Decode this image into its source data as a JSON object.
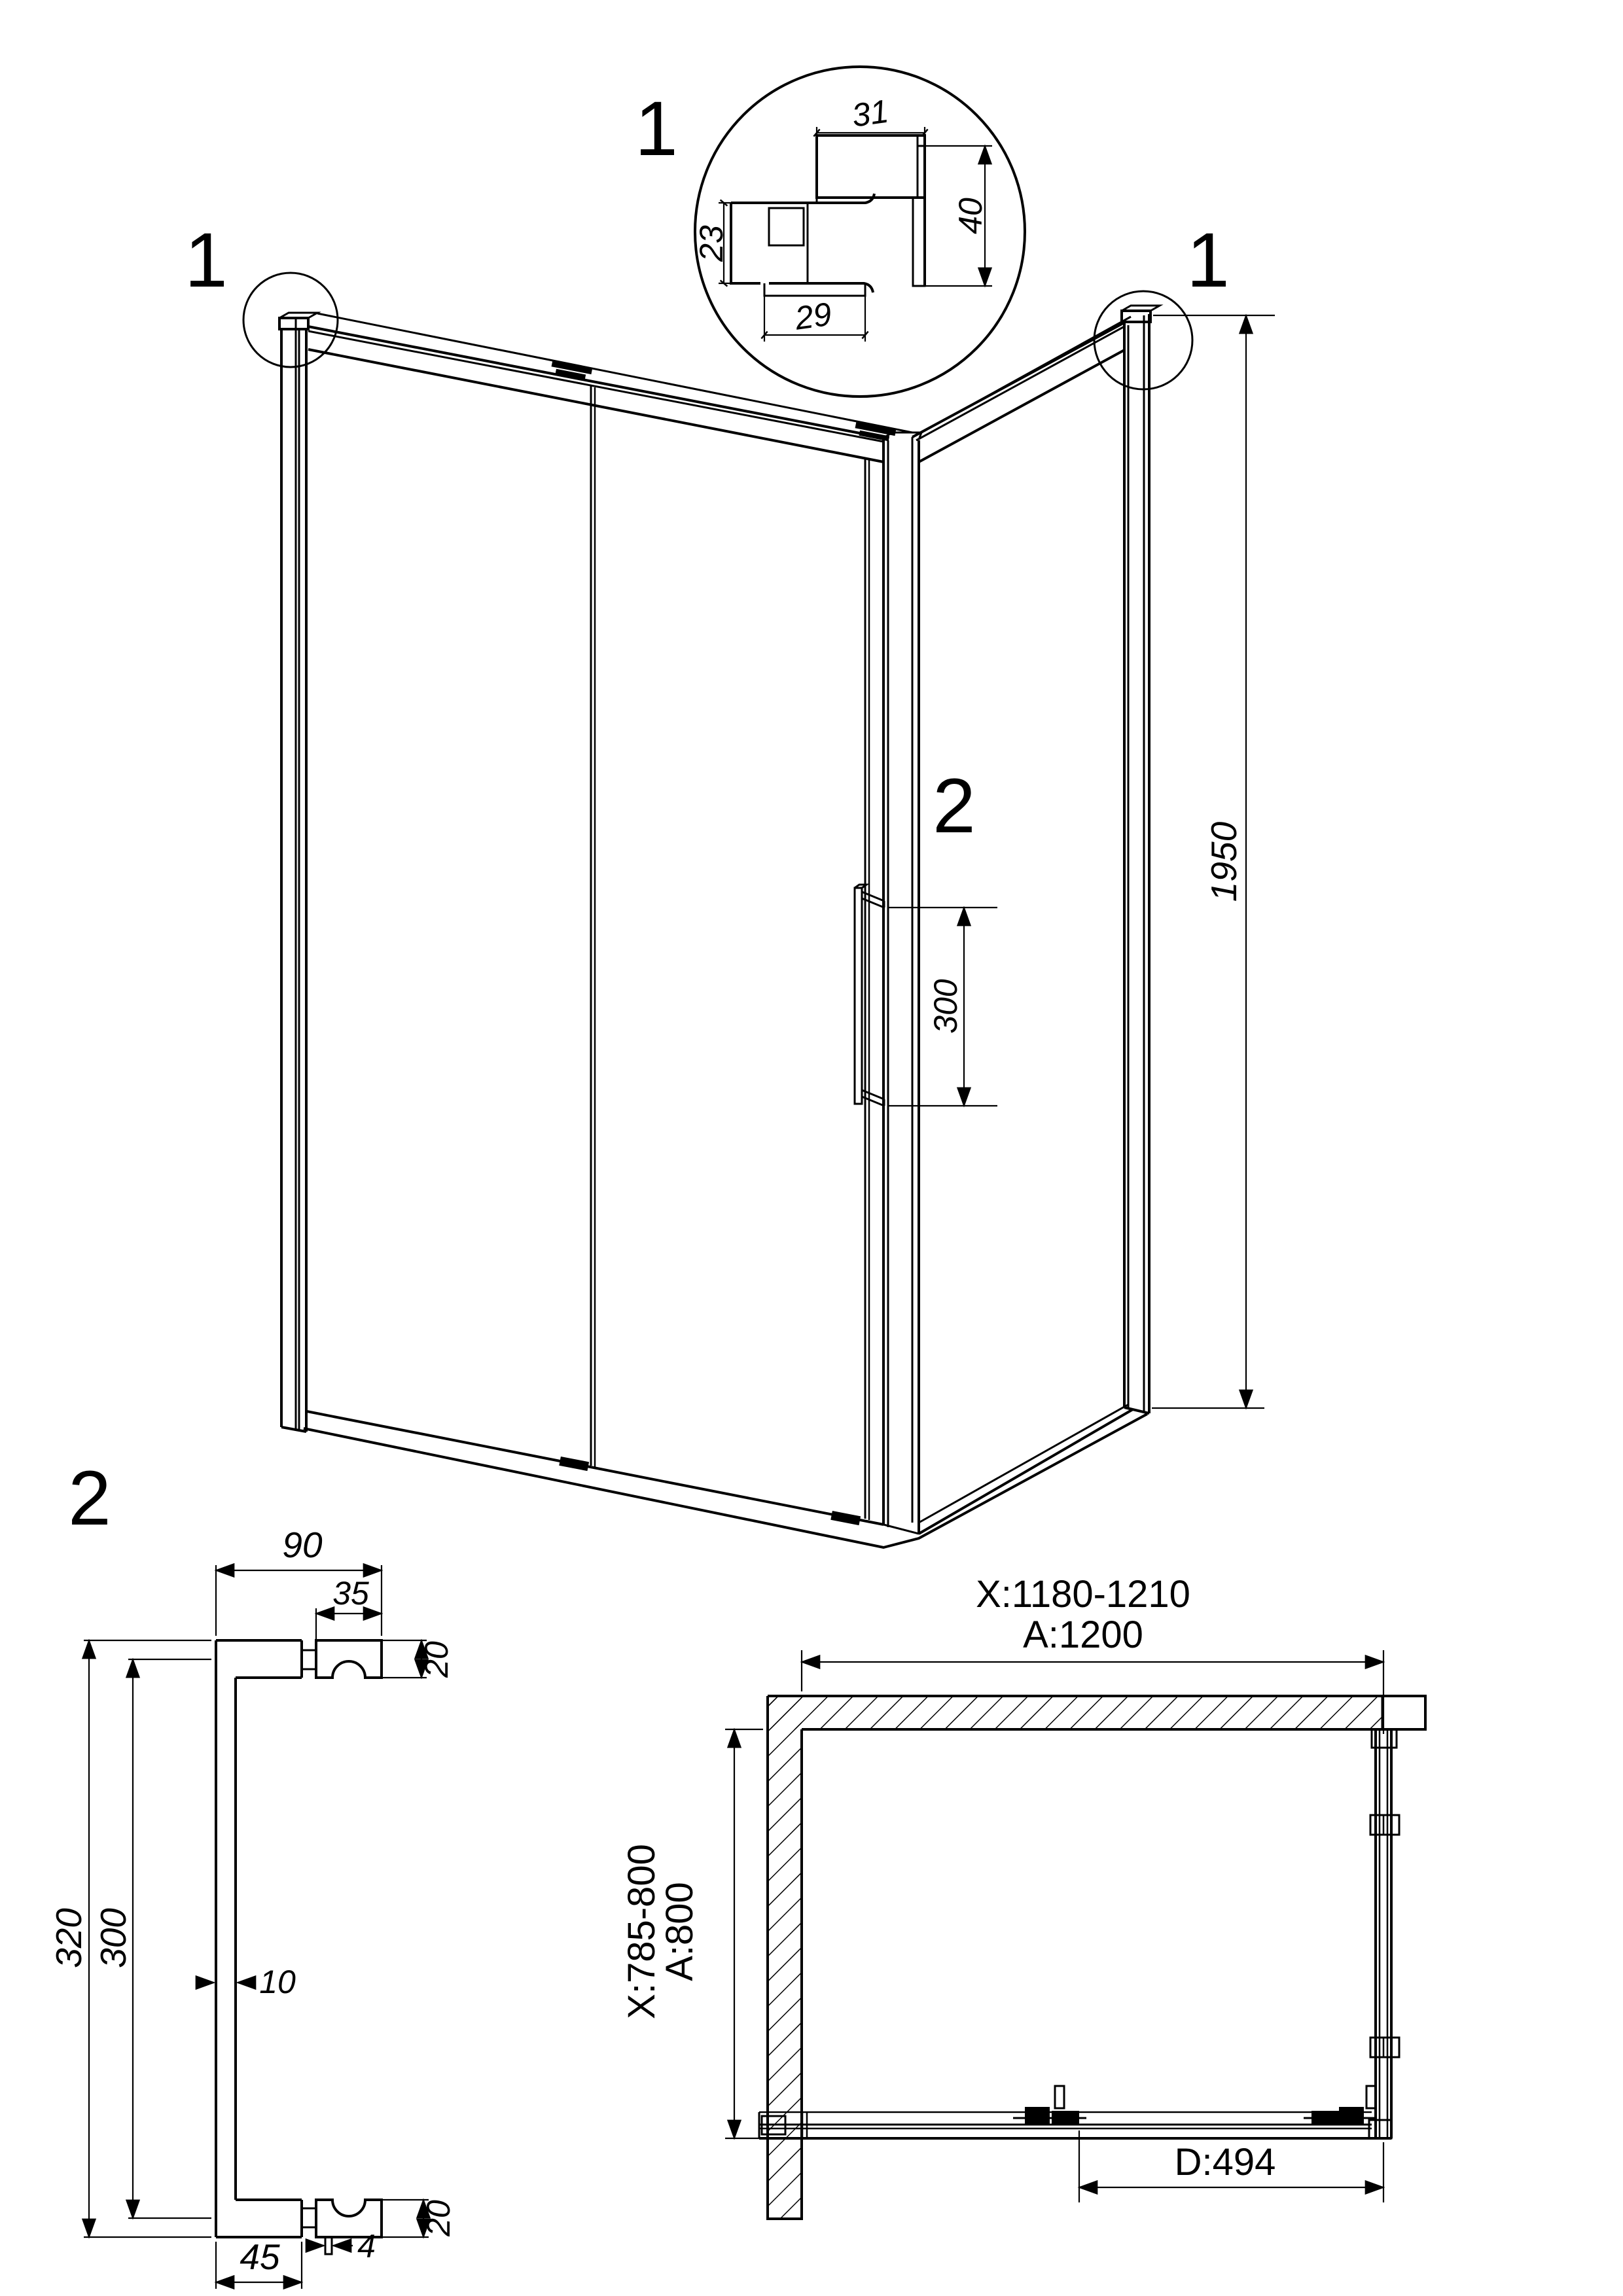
{
  "colors": {
    "line": "#000000",
    "background": "#ffffff"
  },
  "detail_1": {
    "title": "1",
    "dims": {
      "top_width": "31",
      "right_height": "40",
      "left_height": "23",
      "bottom_width": "29"
    }
  },
  "iso_view": {
    "callout_left": "1",
    "callout_right": "1",
    "height_dim": "1950",
    "handle_callout": "2",
    "handle_spacing_dim": "300"
  },
  "handle_detail": {
    "title": "2",
    "dims": {
      "arm_depth": "90",
      "knob_width": "35",
      "arm_thickness_top": "20",
      "overall_height": "320",
      "hole_spacing": "300",
      "grip_thickness": "10",
      "knob_height_bottom": "20",
      "washer_thickness": "4",
      "arm_length_bottom": "45"
    }
  },
  "plan_view": {
    "width_adjustment_range": "X:1180-1210",
    "width_nominal": "A:1200",
    "depth_adjustment_range": "X:785-800",
    "depth_nominal": "A:800",
    "door_opening": "D:494"
  }
}
